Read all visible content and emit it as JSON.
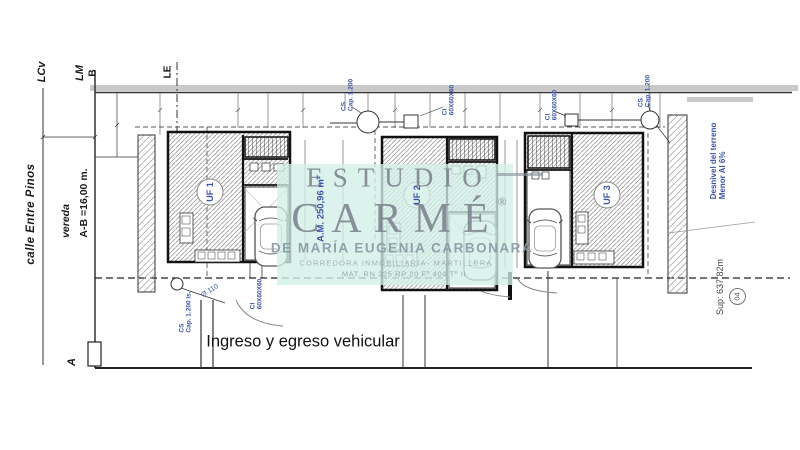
{
  "drawing": {
    "background": "#ffffff",
    "boundary_labels": {
      "lcv": "LCv",
      "lm": "LM",
      "b": "B",
      "le": "LE",
      "a": "A"
    },
    "street": {
      "name": "calle Entre Pinos",
      "sidewalk": "vereda",
      "frontage": "A-B =16,00 m."
    },
    "entry_note": "Ingreso y egreso vehicular",
    "terrain_note": {
      "line1": "Desnivel del terreno",
      "line2": "Menor Al 6%"
    },
    "lot_area": "Sup: 637,82m",
    "sheet_number": "04",
    "unit_area_note": "A.M. 250,96 m²",
    "units": [
      {
        "label": "UF 1"
      },
      {
        "label": "UF 2"
      },
      {
        "label": "UF 3"
      }
    ],
    "service_labels": {
      "cs_top": {
        "line1": "CS",
        "line2": "Cap. 1.200"
      },
      "ci_top": {
        "line1": "CI",
        "line2": "60X60X60"
      },
      "ci_right": {
        "line1": "CI",
        "line2": "60X60X60"
      },
      "cs_right": {
        "line1": "CS",
        "line2": "Cap. 1.200"
      },
      "cs_front": {
        "line1": "CS",
        "line2": "Cap. 1.200 ls."
      },
      "ci_front": {
        "line1": "CI",
        "line2": "60X60X60"
      },
      "pipe_diameter": "Ø 110"
    }
  },
  "watermark": {
    "studio": "ESTUDIO",
    "name": "CARMÉ",
    "registered": "®",
    "owner": "DE MARÍA EUGENIA CARBONARA",
    "role": "CORREDORA INMOBILIARIA- MARTILLERA",
    "license": "MAT. RN 325 RP 20 Fº 404 Tº II"
  },
  "colors": {
    "annotation_blue": "#3d55a6",
    "watermark_gray": "#82889a",
    "watermark_teal": "#d2eee8",
    "line_black": "#1a1a1a",
    "hatch_gray": "#999999"
  }
}
